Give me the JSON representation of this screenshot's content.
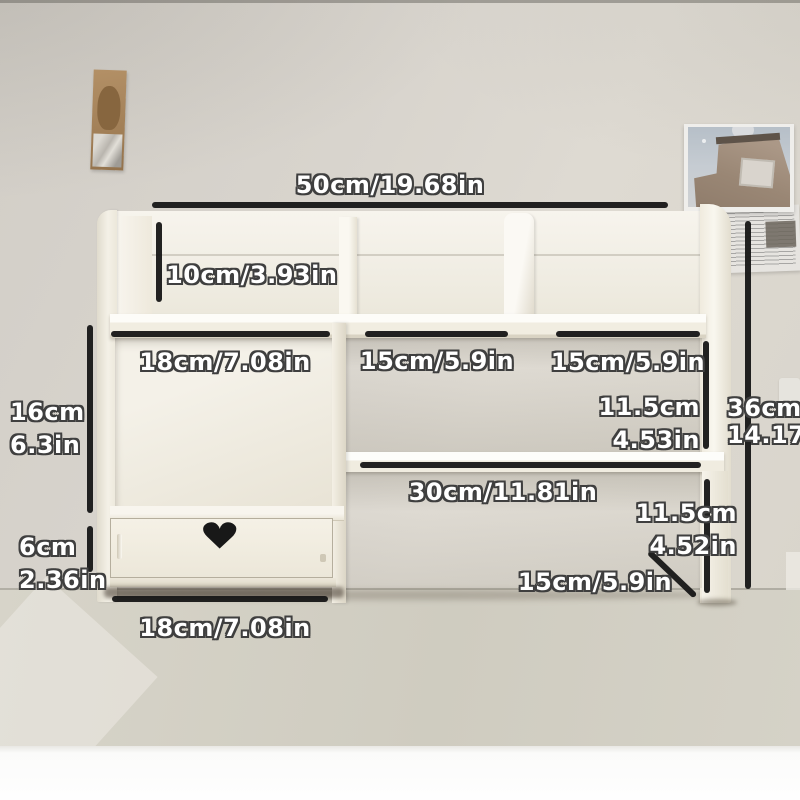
{
  "dimensions": {
    "top_width": {
      "label": "50cm/19.68in"
    },
    "top_inner_height": {
      "label": "10cm/3.93in"
    },
    "left_compartment_width": {
      "label": "18cm/7.08in"
    },
    "middle_compartment_width": {
      "label": "15cm/5.9in"
    },
    "right_compartment_width": {
      "label": "15cm/5.9in"
    },
    "right_upper_inner_height": {
      "cm": "11.5cm",
      "in": "4.53in"
    },
    "total_height": {
      "cm": "36cm",
      "in": "14.17in"
    },
    "left_inner_height": {
      "cm": "16cm",
      "in": "6.3in"
    },
    "drawer_height": {
      "cm": "6cm",
      "in": "2.36in"
    },
    "lower_shelf_width": {
      "label": "30cm/11.81in"
    },
    "right_lower_inner_height": {
      "cm": "11.5cm",
      "in": "4.52in"
    },
    "base_depth": {
      "label": "15cm/5.9in"
    },
    "drawer_width": {
      "label": "18cm/7.08in"
    }
  },
  "decor": {
    "heart_icon": "♥"
  },
  "colors": {
    "measure_line": "#161616",
    "label_text": "#ffffff",
    "label_outline": "#3f3f3f",
    "furniture_cream": "#f3f0e6",
    "wall": "#d8d4cd",
    "desk": "#d2cfc4",
    "heart_cutout": "#181818"
  }
}
